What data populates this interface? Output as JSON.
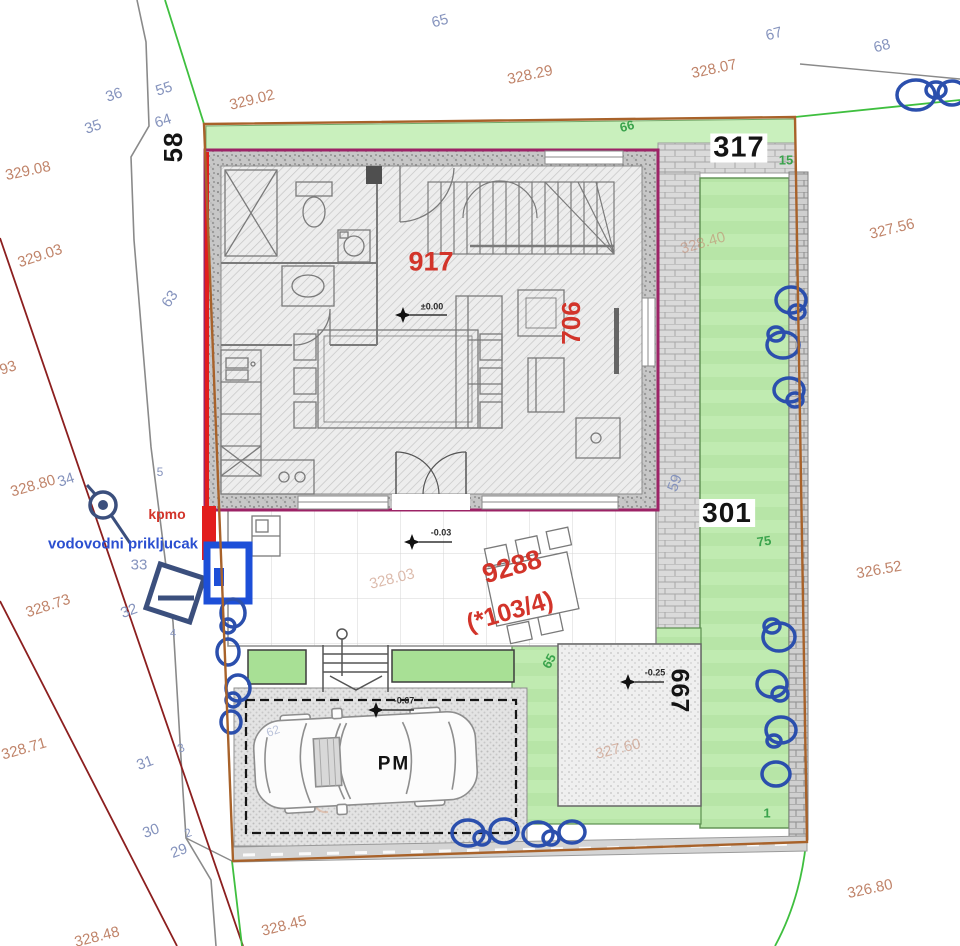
{
  "parcel_numbers": {
    "main": "9288",
    "main_alt": "(*103/4)",
    "building_area": "917",
    "building_side": "706",
    "west": "58",
    "north": "317",
    "east": "301",
    "southeast": "667"
  },
  "survey_points": {
    "pt36": "36",
    "pt55": "55",
    "pt35": "35",
    "pt64": "64",
    "pt65": "65",
    "pt67": "67",
    "pt68": "68",
    "pt63": "63",
    "pt34": "34",
    "pt33": "33",
    "pt32": "32",
    "pt31": "31",
    "pt30": "30",
    "pt29": "29",
    "pt5": "5",
    "pt4": "4",
    "pt3": "3",
    "pt2": "2",
    "pt59": "59",
    "pt62": "62"
  },
  "green_marks": {
    "g66": "66",
    "g15": "15",
    "g75": "75",
    "g65": "65",
    "g1": "1"
  },
  "elevations": {
    "e32902": "329.02",
    "e32829": "328.29",
    "e32807": "328.07",
    "e32908": "329.08",
    "e32903": "329.03",
    "e93": "93",
    "e32880": "328.80",
    "e32873": "328.73",
    "e32871": "328.71",
    "e32848": "328.48",
    "e32845": "328.45",
    "e32756": "327.56",
    "e32652": "326.52",
    "e32680": "326.80",
    "e32840": "328.40",
    "e32803": "328.03",
    "e32760": "327.60"
  },
  "level_marks": {
    "ground": "±0.00",
    "terrace": "-0.03",
    "parking": "-0.67",
    "yard": "-0.25"
  },
  "texts": {
    "kpmo": "kpmo",
    "water_connection": "vodovodni prikljucak",
    "parking_space": "PM"
  },
  "colors": {
    "building_outline": "#9c2366",
    "accent_red": "#e21d1d",
    "boundary_brown": "#a8622a",
    "cadastral_red": "#8c1f1f",
    "survey_green": "#3fbf3f",
    "water_blue": "#1d4fd8",
    "bush_blue": "#2b4fad",
    "elevation_text": "#c0846a",
    "point_text": "#8593bd",
    "green_text": "#3aa34c",
    "label_red": "#d2342a"
  }
}
